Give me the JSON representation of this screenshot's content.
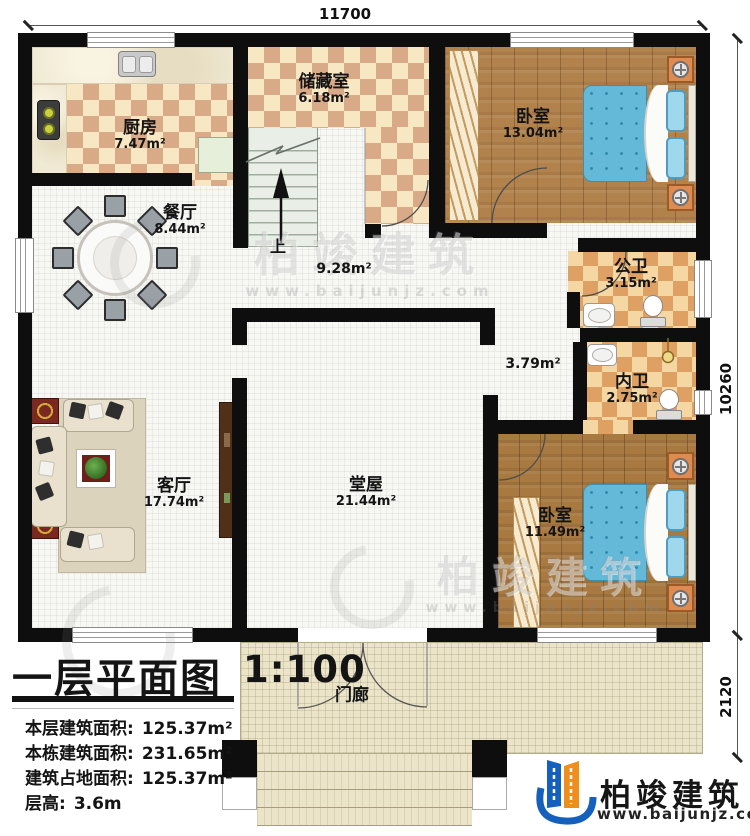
{
  "dimensions": {
    "top": "11700",
    "right": "10260",
    "porch": "2120"
  },
  "rooms": {
    "kitchen": {
      "name": "厨房",
      "area": "7.47m²"
    },
    "storage": {
      "name": "储藏室",
      "area": "6.18m²"
    },
    "dining": {
      "name": "餐厅",
      "area": "8.44m²"
    },
    "bedroom1": {
      "name": "卧室",
      "area": "13.04m²"
    },
    "public_bath": {
      "name": "公卫",
      "area": "3.15m²"
    },
    "inner_bath": {
      "name": "内卫",
      "area": "2.75m²"
    },
    "living": {
      "name": "客厅",
      "area": "17.74m²"
    },
    "hall": {
      "name": "堂屋",
      "area": "21.44m²"
    },
    "bedroom2": {
      "name": "卧室",
      "area": "11.49m²"
    },
    "porch": {
      "name": "门廊"
    },
    "hallway": {
      "area": "9.28m²"
    },
    "corridor": {
      "area": "3.79m²"
    },
    "stairs": {
      "label": "上"
    }
  },
  "title_block": {
    "title": "一层平面图",
    "scale": "1:100",
    "stats": [
      {
        "label": "本层建筑面积:",
        "value": "125.37m²"
      },
      {
        "label": "本栋建筑面积:",
        "value": "231.65m²"
      },
      {
        "label": "建筑占地面积:",
        "value": "125.37m²"
      },
      {
        "label": "层高:",
        "value": "3.6m"
      }
    ]
  },
  "branding": {
    "company": "柏竣建筑",
    "website": "www.baijunjz.com"
  },
  "watermark": {
    "company": "柏竣建筑",
    "website": "www.baijunjz.com"
  },
  "colors": {
    "wall": "#0e0e0e",
    "bed": "#64b9d9",
    "logo_blue": "#1660bd",
    "logo_orange": "#ef8d1d"
  }
}
